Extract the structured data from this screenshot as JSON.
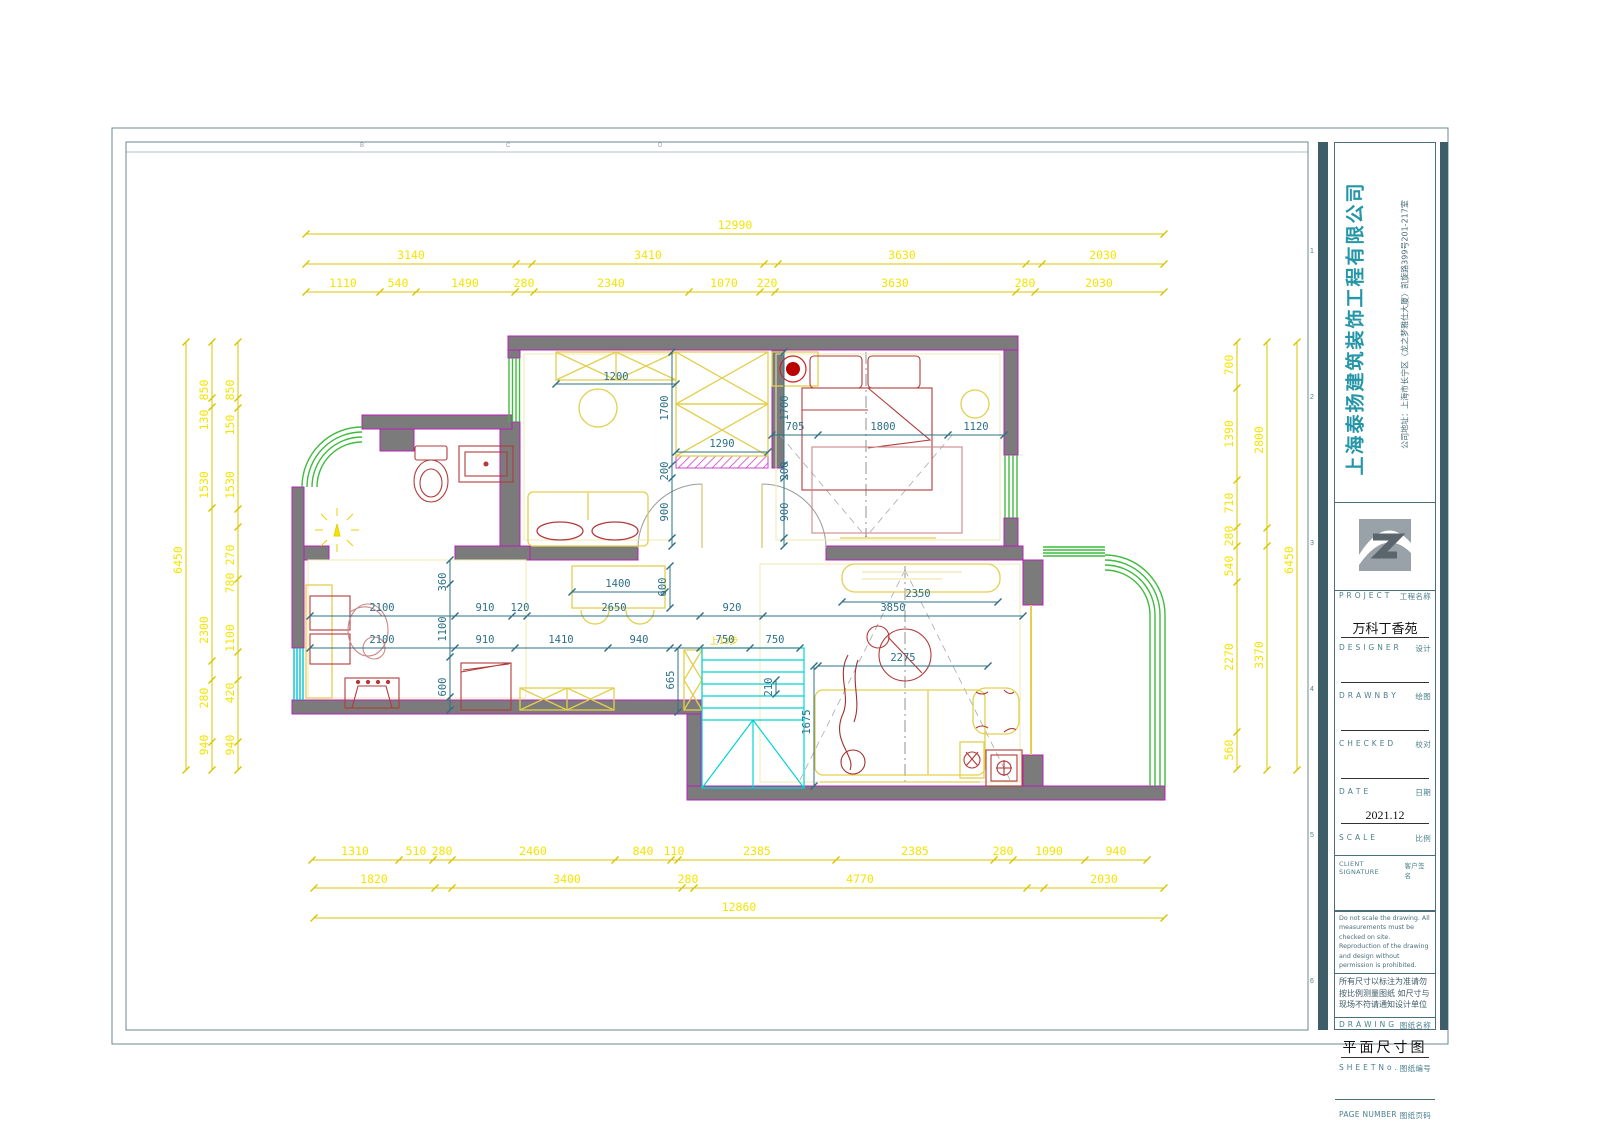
{
  "title_block": {
    "company_name": "上海泰扬建筑装饰工程有限公司",
    "company_address": "公司地址：上海市长宁区〈龙之梦雅仕大厦〉凯旋路399号201-217室",
    "project_en": "P R O J E C T",
    "project_cn": "工程名称",
    "project_value": "万科丁香苑",
    "designer_en": "D E S I G N E R",
    "designer_cn": "设计",
    "drawn_en": "D R A W N   B Y",
    "drawn_cn": "绘图",
    "checked_en": "C H E C K E D",
    "checked_cn": "校对",
    "date_en": "D A T E",
    "date_cn": "日期",
    "date_value": "2021.12",
    "scale_en": "S C A L E",
    "scale_cn": "比例",
    "client_en": "CLIENT SIGNATURE",
    "client_cn": "客户签名",
    "note_en": "Do not scale the drawing. All measurements must be checked on site. Reproduction of the drawing and design without permission is prohibited.",
    "note_cn": "所有尺寸以标注为准请勿按比例测量图纸 如尺寸与现场不符请通知设计单位",
    "drawing_en": "D R A W I N G",
    "drawing_cn": "图纸名称",
    "drawing_value": "平面尺寸图",
    "sheet_en": "S H E E T   N o .",
    "sheet_cn": "图纸编号",
    "page_en": "PAGE NUMBER",
    "page_cn": "图纸页码"
  },
  "sheet_grid": {
    "rows": [
      "1",
      "2",
      "3",
      "4",
      "5",
      "6"
    ],
    "cols": [
      "B",
      "C",
      "D"
    ]
  },
  "colors": {
    "wall": "#7b7b7b",
    "wall_edge": "#b81fb8",
    "window": "#3fbb3f",
    "stairs": "#00d5d5",
    "furniture": "#e3cf4e",
    "red_line": "#b23b3b",
    "dim_outer": "#f5e400",
    "dim_inner": "#2d7086",
    "company": "#2596a8"
  },
  "dims": {
    "top": {
      "total": "12990",
      "row2": [
        "3140",
        "3410",
        "3630",
        "2030"
      ],
      "row3": [
        "1110",
        "540",
        "1490",
        "280",
        "2340",
        "1070",
        "220",
        "3630",
        "280",
        "2030"
      ]
    },
    "bottom": {
      "row1": [
        "1310",
        "510",
        "280",
        "2460",
        "840",
        "110",
        "2385",
        "2385",
        "280",
        "1090",
        "940"
      ],
      "row2": [
        "1820",
        "3400",
        "280",
        "4770",
        "2030"
      ],
      "total": "12860"
    },
    "left": {
      "total": "6450",
      "mid": [
        "850",
        "130",
        "1530",
        "2300",
        "280",
        "940"
      ],
      "inner": [
        "850",
        "150",
        "1530",
        "270",
        "780",
        "1100",
        "420",
        "940"
      ]
    },
    "right": {
      "inner": [
        "700",
        "1390",
        "710",
        "280",
        "540",
        "2270",
        "560"
      ],
      "mid": [
        "2800",
        "3370"
      ],
      "total": "6450"
    },
    "interior": {
      "h1": [
        "2100",
        "910",
        "120",
        "2650",
        "920",
        "3850"
      ],
      "h2": [
        "2100",
        "910",
        "1410",
        "940",
        "750",
        "750"
      ],
      "v1": [
        "360",
        "1100",
        "600"
      ],
      "bed": [
        "705",
        "1800",
        "1120"
      ],
      "wardrobe_side": [
        "1700",
        "200",
        "900"
      ],
      "cabinet": "1200",
      "wardrobe_w": "1290",
      "table": [
        "1400",
        "600"
      ],
      "tv": "2350",
      "sofa": "2275",
      "stairs": [
        "665",
        "210",
        "1675"
      ],
      "stair_note": "上13步"
    }
  }
}
